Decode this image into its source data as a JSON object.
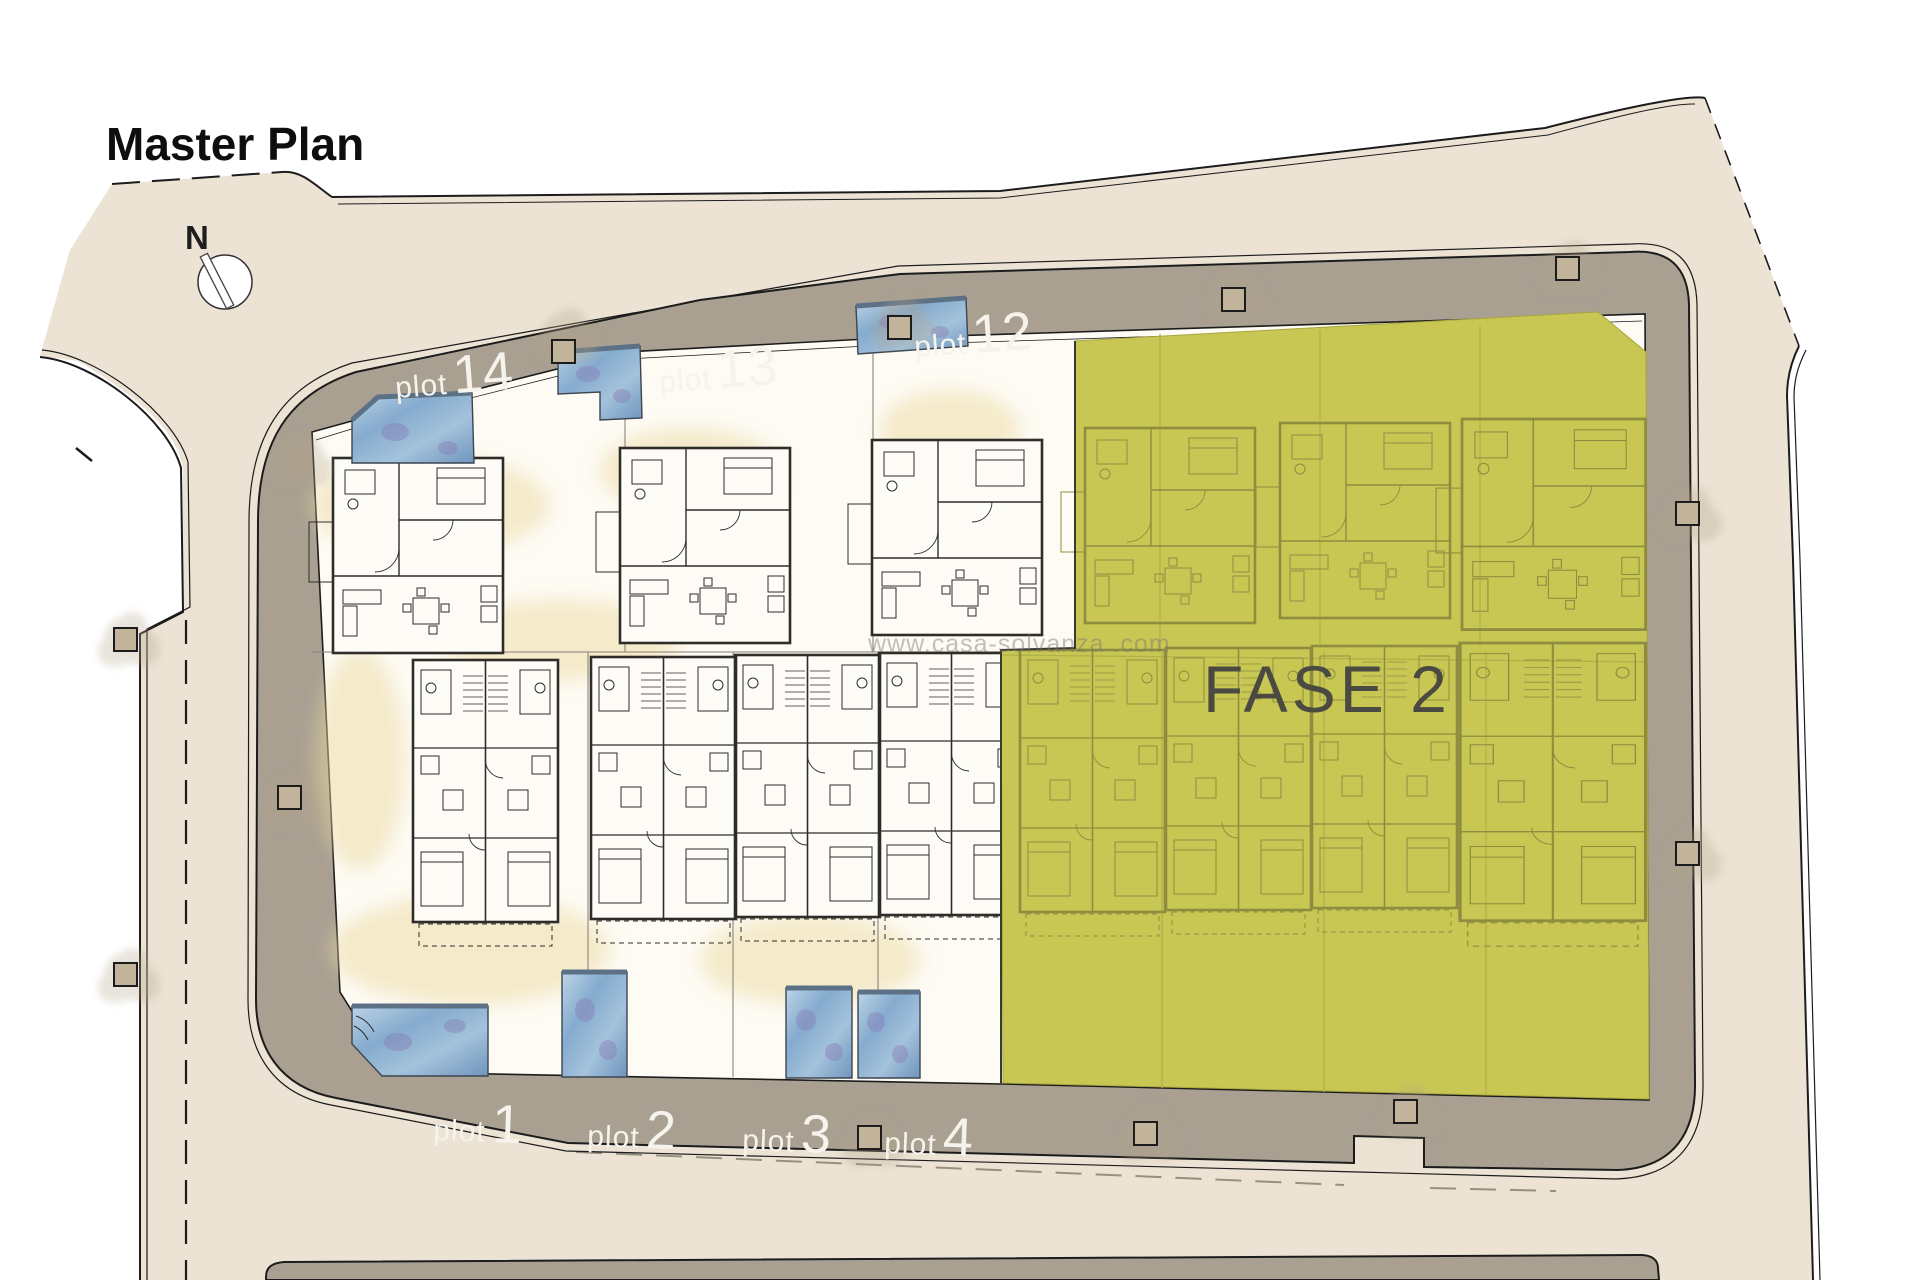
{
  "title": "Master Plan",
  "compass": {
    "label": "N"
  },
  "watermark": "www.casa-solvanza .com",
  "phase": {
    "label": "FASE 2"
  },
  "plots": {
    "top": [
      {
        "prefix": "plot",
        "number": "14"
      },
      {
        "prefix": "plot",
        "number": "13"
      },
      {
        "prefix": "plot",
        "number": "12"
      }
    ],
    "bottom": [
      {
        "prefix": "plot",
        "number": "1"
      },
      {
        "prefix": "plot",
        "number": "2"
      },
      {
        "prefix": "plot",
        "number": "3"
      },
      {
        "prefix": "plot",
        "number": "4"
      }
    ]
  },
  "colors": {
    "ink": "#1c1c1c",
    "site_beige": "#ece3d4",
    "road_gray": "#a9a092",
    "panel_white": "#fdfbf4",
    "sand": "#eeda9f",
    "phase_olive": "#c9c754",
    "phase_text": "#4b4a42",
    "pool_blue": "#8fb3d4",
    "label_white": "#f6f3ec"
  }
}
